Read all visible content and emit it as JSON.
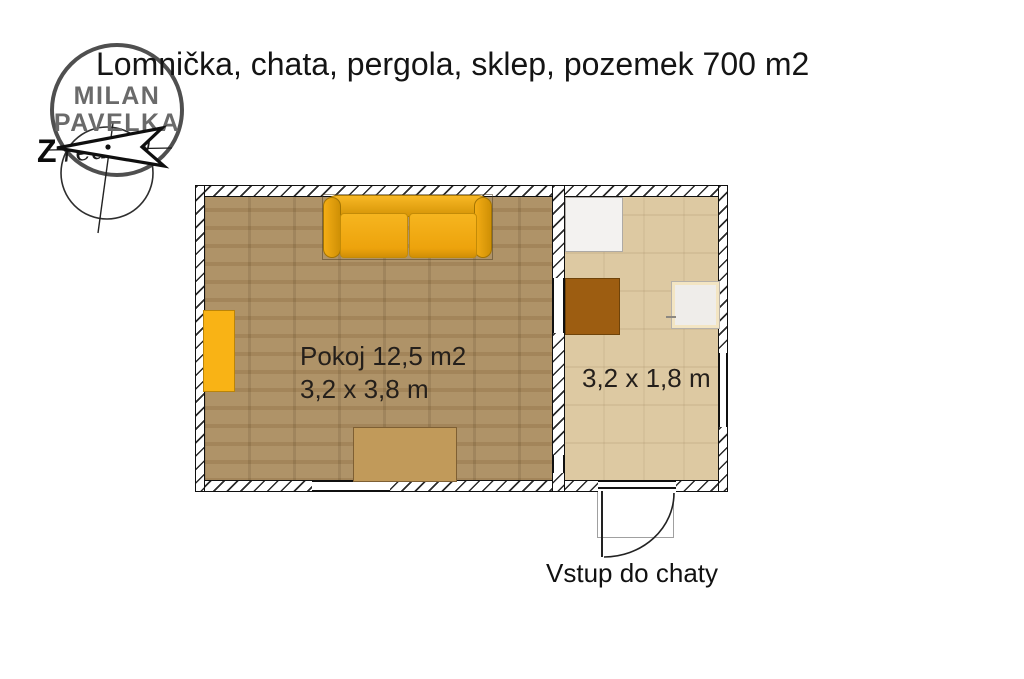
{
  "title": "Lomnička, chata, pergola, sklep, pozemek 700 m2",
  "logo": {
    "line1": "MILAN",
    "line2": "PAVELKA",
    "script": "reality",
    "compass_letter": "Z"
  },
  "plan": {
    "room1": {
      "name": "Pokoj 12,5 m2",
      "size": "3,2 x 3,8 m"
    },
    "room2": {
      "size": "3,2 x 1,8 m"
    },
    "entrance_label": "Vstup do chaty"
  },
  "colors": {
    "room1_floor": "#ab8d60",
    "room2_floor": "#ddc9a2",
    "sofa_orange": "#f2ab13",
    "sideboard_orange": "#f9b315",
    "table_tan": "#c19a5a",
    "cabinet_brown": "#9d5d11",
    "fridge_white": "#f3f2f0",
    "wall_line": "#101010",
    "logo_gray": "#6a6a6a"
  }
}
